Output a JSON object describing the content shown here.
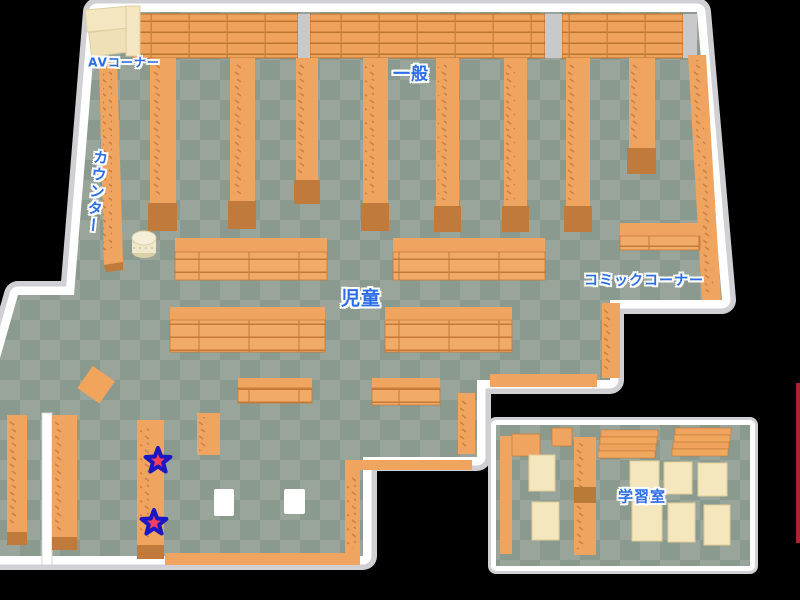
{
  "map": {
    "type": "library-floor-map",
    "areas": [
      {
        "id": "av-corner",
        "label": "AVコーナー"
      },
      {
        "id": "general",
        "label": "一般"
      },
      {
        "id": "counter",
        "label": "カウンター"
      },
      {
        "id": "children",
        "label": "児童"
      },
      {
        "id": "comic-corner",
        "label": "コミックコーナー"
      },
      {
        "id": "study-room",
        "label": "学習室"
      }
    ],
    "markers": [
      {
        "id": "star-1",
        "shape": "star"
      },
      {
        "id": "star-2",
        "shape": "star"
      }
    ],
    "colors": {
      "background": "#000000",
      "floor_light": "#99a59b",
      "floor_dark": "#8b9a8f",
      "wall": "#ffffff",
      "wall_shadow": "#cfcfd4",
      "shelf": "#efa45f",
      "shelf_dark": "#c07a3c",
      "furniture_cream": "#f4e7c0",
      "label_text": "#2b6ce8",
      "label_outline": "#ffffff",
      "star_fill": "#f2405c",
      "star_outline": "#1b16c6",
      "edge_line": "#ae2334"
    }
  }
}
